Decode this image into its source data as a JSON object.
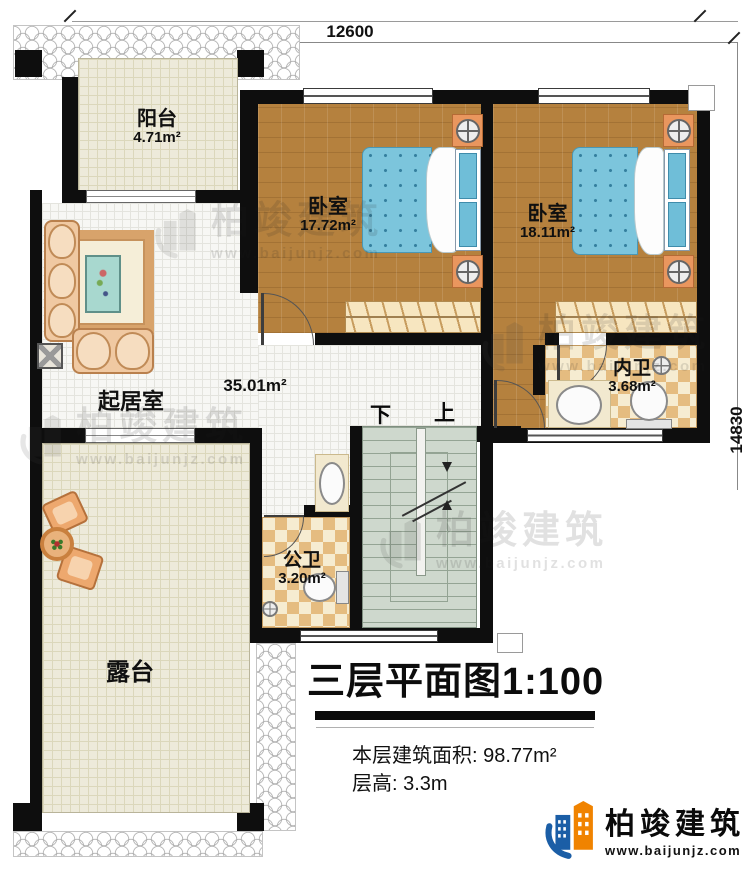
{
  "plan": {
    "dim_top": "12600",
    "dim_right": "14830"
  },
  "rooms": {
    "balcony": {
      "name": "阳台",
      "area": "4.71m²"
    },
    "bedroom_left": {
      "name": "卧室",
      "area": "17.72m²"
    },
    "bedroom_right": {
      "name": "卧室",
      "area": "18.11m²"
    },
    "living_room": {
      "name": "起居室",
      "area": "35.01m²"
    },
    "inner_bathroom": {
      "name": "内卫",
      "area": "3.68m²"
    },
    "public_bathroom": {
      "name": "公卫",
      "area": "3.20m²"
    },
    "terrace": {
      "name": "露台"
    }
  },
  "stairs": {
    "down_label": "下",
    "up_label": "上"
  },
  "title_block": {
    "title": "三层平面图1:100",
    "area_label": "本层建筑面积: ",
    "area_value": "98.77m²",
    "height_label": "层高: ",
    "height_value": "3.3m"
  },
  "brand": {
    "name": "柏竣建筑",
    "website": "www.baijunjz.com"
  },
  "watermark": {
    "name": "柏竣建筑",
    "website": "www.baijunjz.com"
  },
  "colors": {
    "wall": "#0e0e0e",
    "wood_floor": "#b5813e",
    "bed_blue": "#7cc5dc",
    "bath_tile": "#e5bc80",
    "stairs_green": "#ced8cd",
    "brand_blue": "#1b5ea6",
    "brand_orange": "#f08300"
  }
}
